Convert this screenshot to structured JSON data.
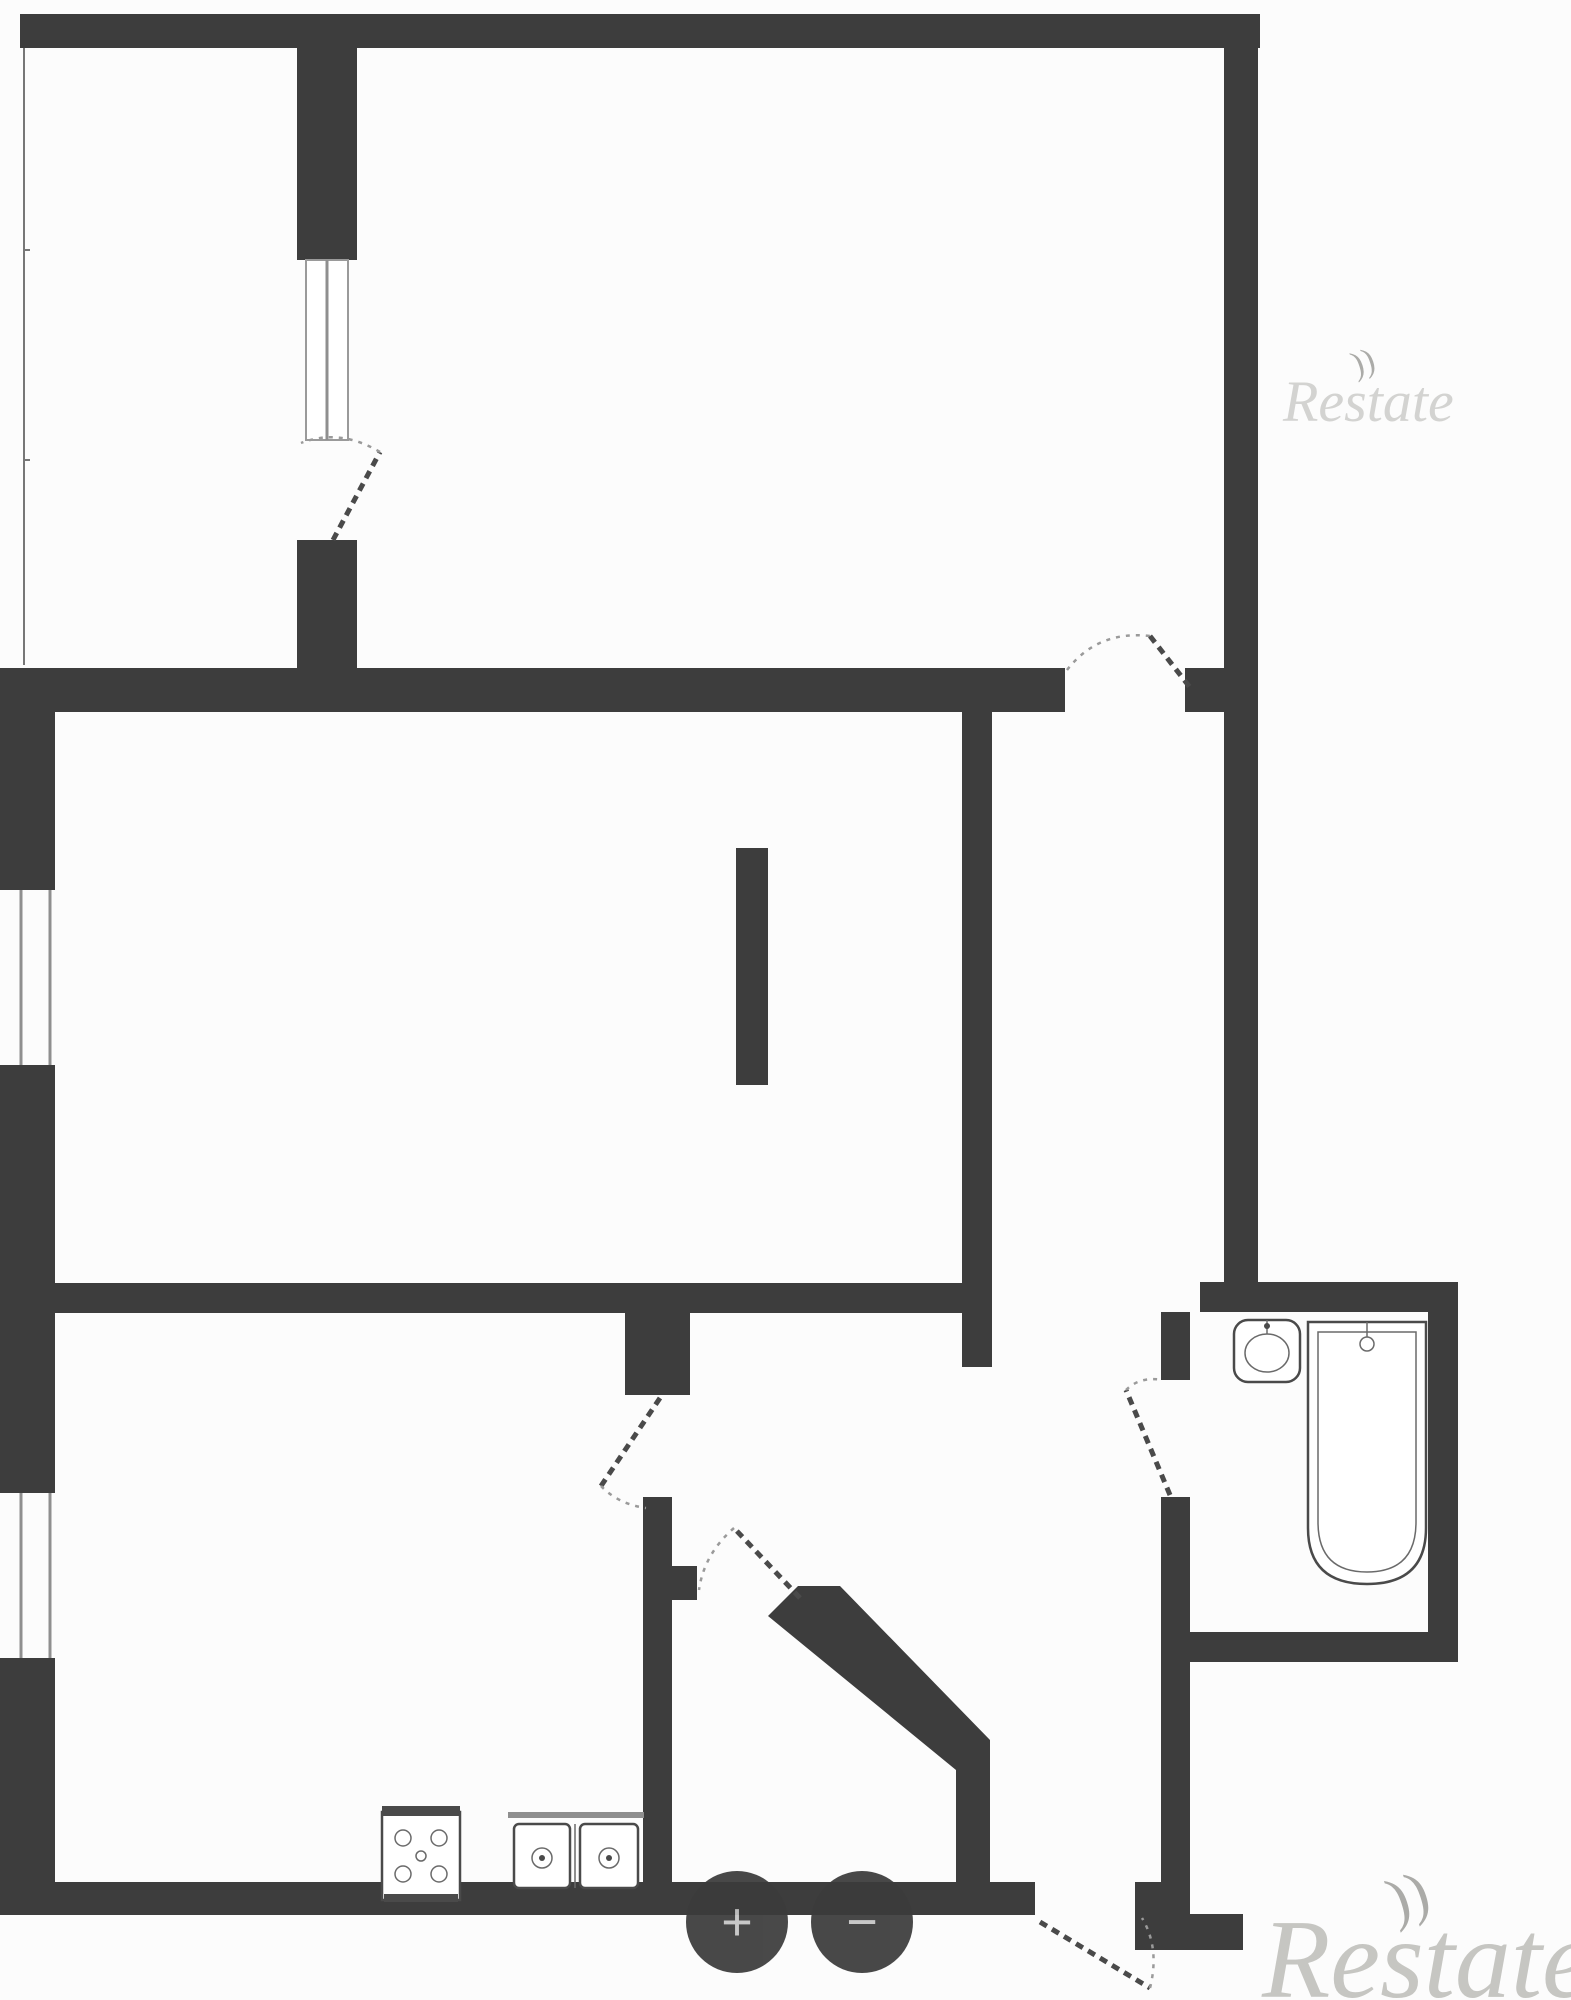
{
  "image": {
    "width": 1571,
    "height": 2000,
    "background": "#fcfcfc"
  },
  "plan": {
    "wall_color": "#3d3d3d",
    "fixture_line_color": "#4a4a4a",
    "window_line_color": "#8f8f8f",
    "door_arc_color": "#9a9a9a",
    "rooms": [
      {
        "name": "balcony"
      },
      {
        "name": "bedroom"
      },
      {
        "name": "living-room"
      },
      {
        "name": "storage-nook"
      },
      {
        "name": "kitchen"
      },
      {
        "name": "hallway"
      },
      {
        "name": "corridor"
      },
      {
        "name": "bathroom"
      }
    ],
    "fixtures": [
      {
        "name": "stove-icon"
      },
      {
        "name": "kitchen-double-sink-icon"
      },
      {
        "name": "bathroom-sink-icon"
      },
      {
        "name": "bathtub-icon"
      }
    ],
    "doors": [
      {
        "name": "balcony-door"
      },
      {
        "name": "bedroom-door"
      },
      {
        "name": "kitchen-door"
      },
      {
        "name": "hallway-door"
      },
      {
        "name": "bathroom-door"
      },
      {
        "name": "entrance-door"
      }
    ]
  },
  "controls": {
    "zoom_in_label": "+",
    "zoom_out_label": "−",
    "button_color": "#3b3b3b",
    "glyph_color": "#c5c5c5"
  },
  "watermarks": {
    "top_right": "Restate",
    "bottom_right": "Restate",
    "swoosh": "))",
    "top_color": "#d3d3d1",
    "bottom_color": "#c6c6c2"
  }
}
